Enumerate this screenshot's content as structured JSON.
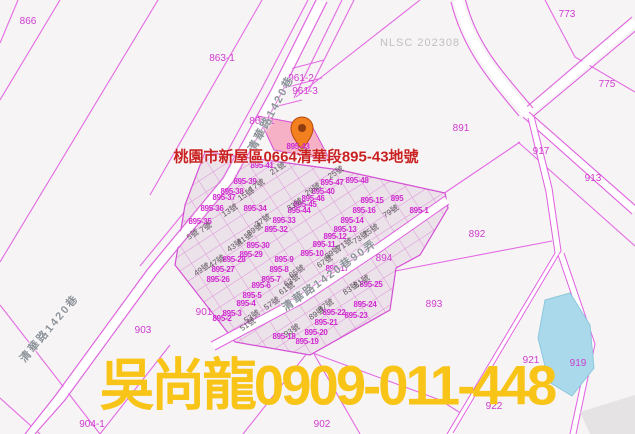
{
  "map": {
    "annotation": "桃園市新屋區0664清華段895-43地號",
    "agent_watermark": "吳尚龍0909-011-448",
    "source_watermark": "NLSC 202308",
    "highlighted_parcel": "895-43",
    "colors": {
      "parcel_line": "#e46ae4",
      "lot_label": "#d02ad0",
      "highlight_fill": "#f5aac2",
      "water_fill": "#a9d9ea",
      "annotation_red": "#c92121",
      "agent_yellow": "#f8c418",
      "pin_orange": "#f2801e"
    },
    "labels": [
      {
        "t": "866",
        "x": 28,
        "y": 22,
        "c": "p"
      },
      {
        "t": "863-1",
        "x": 222,
        "y": 59,
        "c": "p"
      },
      {
        "t": "961-2",
        "x": 301,
        "y": 79,
        "c": "p"
      },
      {
        "t": "961-3",
        "x": 305,
        "y": 92,
        "c": "p"
      },
      {
        "t": "861-1",
        "x": 262,
        "y": 122,
        "c": "p"
      },
      {
        "t": "773",
        "x": 567,
        "y": 15,
        "c": "p"
      },
      {
        "t": "775",
        "x": 607,
        "y": 85,
        "c": "p"
      },
      {
        "t": "891",
        "x": 461,
        "y": 129,
        "c": "p"
      },
      {
        "t": "917",
        "x": 541,
        "y": 152,
        "c": "p"
      },
      {
        "t": "913",
        "x": 593,
        "y": 179,
        "c": "p"
      },
      {
        "t": "892",
        "x": 477,
        "y": 235,
        "c": "p"
      },
      {
        "t": "893",
        "x": 434,
        "y": 305,
        "c": "p"
      },
      {
        "t": "894",
        "x": 384,
        "y": 259,
        "c": "p"
      },
      {
        "t": "921",
        "x": 531,
        "y": 361,
        "c": "p"
      },
      {
        "t": "919",
        "x": 578,
        "y": 364,
        "c": "p"
      },
      {
        "t": "922",
        "x": 494,
        "y": 407,
        "c": "p"
      },
      {
        "t": "902",
        "x": 322,
        "y": 425,
        "c": "p"
      },
      {
        "t": "903",
        "x": 143,
        "y": 331,
        "c": "p"
      },
      {
        "t": "904-1",
        "x": 92,
        "y": 425,
        "c": "p"
      },
      {
        "t": "901",
        "x": 204,
        "y": 313,
        "c": "p"
      },
      {
        "t": "895-43",
        "x": 298,
        "y": 147,
        "c": "l"
      },
      {
        "t": "895-41",
        "x": 262,
        "y": 166,
        "c": "l"
      },
      {
        "t": "895-39",
        "x": 245,
        "y": 182,
        "c": "l"
      },
      {
        "t": "895-38",
        "x": 232,
        "y": 192,
        "c": "l"
      },
      {
        "t": "895-37",
        "x": 224,
        "y": 198,
        "c": "l"
      },
      {
        "t": "895-36",
        "x": 212,
        "y": 209,
        "c": "l"
      },
      {
        "t": "895-35",
        "x": 200,
        "y": 222,
        "c": "l"
      },
      {
        "t": "895-34",
        "x": 255,
        "y": 209,
        "c": "l"
      },
      {
        "t": "895-33",
        "x": 284,
        "y": 221,
        "c": "l"
      },
      {
        "t": "895-32",
        "x": 276,
        "y": 230,
        "c": "l"
      },
      {
        "t": "895-30",
        "x": 258,
        "y": 246,
        "c": "l"
      },
      {
        "t": "895-29",
        "x": 251,
        "y": 255,
        "c": "l"
      },
      {
        "t": "895-28",
        "x": 234,
        "y": 260,
        "c": "l"
      },
      {
        "t": "895-27",
        "x": 223,
        "y": 270,
        "c": "l"
      },
      {
        "t": "895-26",
        "x": 218,
        "y": 280,
        "c": "l"
      },
      {
        "t": "895-48",
        "x": 357,
        "y": 181,
        "c": "l"
      },
      {
        "t": "895-47",
        "x": 332,
        "y": 183,
        "c": "l"
      },
      {
        "t": "895-40",
        "x": 323,
        "y": 192,
        "c": "l"
      },
      {
        "t": "895-46",
        "x": 313,
        "y": 199,
        "c": "l"
      },
      {
        "t": "895-45",
        "x": 305,
        "y": 205,
        "c": "l"
      },
      {
        "t": "895-44",
        "x": 299,
        "y": 211,
        "c": "l"
      },
      {
        "t": "895-15",
        "x": 372,
        "y": 201,
        "c": "l"
      },
      {
        "t": "895",
        "x": 397,
        "y": 199,
        "c": "l"
      },
      {
        "t": "895-16",
        "x": 364,
        "y": 211,
        "c": "l"
      },
      {
        "t": "895-1",
        "x": 419,
        "y": 211,
        "c": "l"
      },
      {
        "t": "895-14",
        "x": 352,
        "y": 221,
        "c": "l"
      },
      {
        "t": "895-13",
        "x": 345,
        "y": 230,
        "c": "l"
      },
      {
        "t": "895-12",
        "x": 335,
        "y": 237,
        "c": "l"
      },
      {
        "t": "895-11",
        "x": 324,
        "y": 245,
        "c": "l"
      },
      {
        "t": "895-10",
        "x": 312,
        "y": 254,
        "c": "l"
      },
      {
        "t": "895-9",
        "x": 284,
        "y": 260,
        "c": "l"
      },
      {
        "t": "895-8",
        "x": 279,
        "y": 270,
        "c": "l"
      },
      {
        "t": "895-7",
        "x": 271,
        "y": 280,
        "c": "l"
      },
      {
        "t": "895-6",
        "x": 261,
        "y": 286,
        "c": "l"
      },
      {
        "t": "895-5",
        "x": 252,
        "y": 296,
        "c": "l"
      },
      {
        "t": "895-4",
        "x": 246,
        "y": 304,
        "c": "l"
      },
      {
        "t": "895-3",
        "x": 232,
        "y": 314,
        "c": "l"
      },
      {
        "t": "895-2",
        "x": 222,
        "y": 319,
        "c": "l"
      },
      {
        "t": "895-17",
        "x": 337,
        "y": 269,
        "c": "l"
      },
      {
        "t": "895-25",
        "x": 371,
        "y": 285,
        "c": "l"
      },
      {
        "t": "895-24",
        "x": 365,
        "y": 305,
        "c": "l"
      },
      {
        "t": "895-23",
        "x": 356,
        "y": 316,
        "c": "l"
      },
      {
        "t": "895-22",
        "x": 334,
        "y": 313,
        "c": "l"
      },
      {
        "t": "895-21",
        "x": 326,
        "y": 323,
        "c": "l"
      },
      {
        "t": "895-20",
        "x": 316,
        "y": 333,
        "c": "l"
      },
      {
        "t": "895-19",
        "x": 307,
        "y": 342,
        "c": "l"
      },
      {
        "t": "895-18",
        "x": 284,
        "y": 337,
        "c": "l"
      },
      {
        "t": "5號",
        "x": 193,
        "y": 235,
        "c": "h",
        "r": -33
      },
      {
        "t": "7號",
        "x": 206,
        "y": 228,
        "c": "h",
        "r": -33
      },
      {
        "t": "13號",
        "x": 230,
        "y": 211,
        "c": "h",
        "r": -33
      },
      {
        "t": "15號",
        "x": 246,
        "y": 195,
        "c": "h",
        "r": -33
      },
      {
        "t": "17號",
        "x": 257,
        "y": 186,
        "c": "h",
        "r": -33
      },
      {
        "t": "21號",
        "x": 278,
        "y": 169,
        "c": "h",
        "r": -33
      },
      {
        "t": "25號",
        "x": 336,
        "y": 173,
        "c": "h",
        "r": -33
      },
      {
        "t": "29號",
        "x": 313,
        "y": 190,
        "c": "h",
        "r": -33
      },
      {
        "t": "33號",
        "x": 295,
        "y": 205,
        "c": "h",
        "r": -33
      },
      {
        "t": "37號",
        "x": 263,
        "y": 221,
        "c": "h",
        "r": -33
      },
      {
        "t": "39號",
        "x": 255,
        "y": 230,
        "c": "h",
        "r": -33
      },
      {
        "t": "41號",
        "x": 245,
        "y": 239,
        "c": "h",
        "r": -33
      },
      {
        "t": "43號",
        "x": 235,
        "y": 246,
        "c": "h",
        "r": -33
      },
      {
        "t": "47號",
        "x": 217,
        "y": 262,
        "c": "h",
        "r": -33
      },
      {
        "t": "49號",
        "x": 202,
        "y": 270,
        "c": "h",
        "r": -33
      },
      {
        "t": "51號",
        "x": 248,
        "y": 325,
        "c": "h",
        "r": -33
      },
      {
        "t": "53號",
        "x": 252,
        "y": 317,
        "c": "h",
        "r": -33
      },
      {
        "t": "57號",
        "x": 272,
        "y": 304,
        "c": "h",
        "r": -33
      },
      {
        "t": "61號",
        "x": 287,
        "y": 289,
        "c": "h",
        "r": -33
      },
      {
        "t": "63號",
        "x": 292,
        "y": 281,
        "c": "h",
        "r": -33
      },
      {
        "t": "65號",
        "x": 297,
        "y": 272,
        "c": "h",
        "r": -33
      },
      {
        "t": "67號",
        "x": 325,
        "y": 262,
        "c": "h",
        "r": -33
      },
      {
        "t": "69號",
        "x": 333,
        "y": 253,
        "c": "h",
        "r": -33
      },
      {
        "t": "71號",
        "x": 345,
        "y": 245,
        "c": "h",
        "r": -33
      },
      {
        "t": "73號",
        "x": 361,
        "y": 238,
        "c": "h",
        "r": -33
      },
      {
        "t": "75號",
        "x": 371,
        "y": 231,
        "c": "h",
        "r": -33
      },
      {
        "t": "79號",
        "x": 391,
        "y": 212,
        "c": "h",
        "r": -33
      },
      {
        "t": "81號",
        "x": 362,
        "y": 282,
        "c": "h",
        "r": -33
      },
      {
        "t": "83號",
        "x": 351,
        "y": 289,
        "c": "h",
        "r": -33
      },
      {
        "t": "87號",
        "x": 326,
        "y": 306,
        "c": "h",
        "r": -33
      },
      {
        "t": "89號",
        "x": 317,
        "y": 314,
        "c": "h",
        "r": -33
      },
      {
        "t": "93號",
        "x": 292,
        "y": 331,
        "c": "h",
        "r": -33
      },
      {
        "t": "清華路1420巷",
        "x": 272,
        "y": 114,
        "c": "r",
        "r": -62
      },
      {
        "t": "清華路1420巷90弄",
        "x": 330,
        "y": 276,
        "c": "r",
        "r": -36
      },
      {
        "t": "清華路1420巷",
        "x": 50,
        "y": 329,
        "c": "r",
        "r": -50
      }
    ]
  }
}
